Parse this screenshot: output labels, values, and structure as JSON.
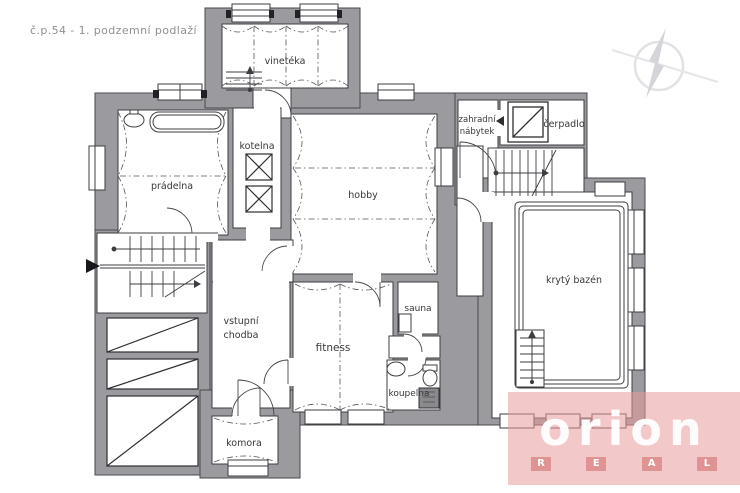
{
  "page": {
    "title": "č.p.54 - 1. podzemní podlaží"
  },
  "plan": {
    "rooms": {
      "vineteka": "vinetéka",
      "pradelna": "prádelna",
      "kotelna": "kotelna",
      "hobby": "hobby",
      "zahradni_nabytek": {
        "line1": "zahradní",
        "line2": "nábytek"
      },
      "cerpadlo": "čerpadlo",
      "kryty_bazen": "krytý bazén",
      "vstupni_chodba": {
        "line1": "vstupní",
        "line2": "chodba"
      },
      "fitness": "fitness",
      "sauna": "sauna",
      "koupelna": "koupelna",
      "komora": "komora"
    },
    "colors": {
      "wall_fill": "#9b9b9f",
      "wall_stroke": "#47474c",
      "room_fill": "#ffffff",
      "line": "#3e3e42",
      "logo_pink": "#e99b9b"
    }
  },
  "logo": {
    "brand": "orion",
    "sub": [
      "R",
      "E",
      "A",
      "L"
    ]
  }
}
